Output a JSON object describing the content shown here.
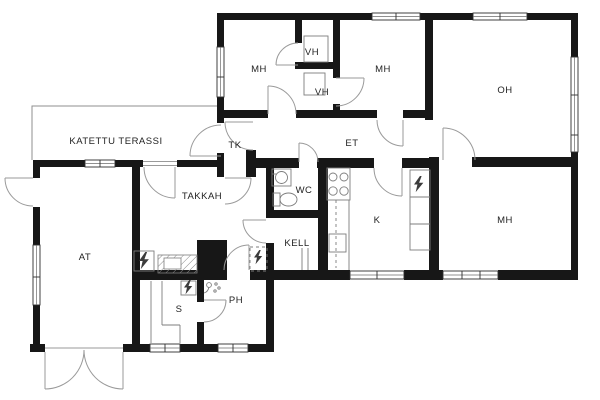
{
  "plan": {
    "title": "floor-plan",
    "rooms": [
      {
        "id": "terrace",
        "label": "KATETTU TERASSI"
      },
      {
        "id": "mh-top-left",
        "label": "MH"
      },
      {
        "id": "vh-upper",
        "label": "VH"
      },
      {
        "id": "vh-lower",
        "label": "VH"
      },
      {
        "id": "mh-top-mid",
        "label": "MH"
      },
      {
        "id": "oh",
        "label": "OH"
      },
      {
        "id": "tk",
        "label": "TK"
      },
      {
        "id": "et",
        "label": "ET"
      },
      {
        "id": "wc",
        "label": "WC"
      },
      {
        "id": "takkah",
        "label": "TAKKAH"
      },
      {
        "id": "kell",
        "label": "KELL"
      },
      {
        "id": "k",
        "label": "K"
      },
      {
        "id": "mh-bottom",
        "label": "MH"
      },
      {
        "id": "at",
        "label": "AT"
      },
      {
        "id": "s",
        "label": "S"
      },
      {
        "id": "ph",
        "label": "PH"
      }
    ],
    "icons": [
      "fireplace",
      "hearth-hatch",
      "stove-burners",
      "kitchen-cabinets",
      "washbasin",
      "toilet",
      "shower-mixer",
      "sauna-stove-electric",
      "electric-panel",
      "water-heater-electric",
      "sauna-benches",
      "closet-shelf",
      "cellar-hatch"
    ],
    "colors": {
      "wall": "#171717",
      "line": "#8f8f8f",
      "window": "#2e2e2e",
      "label": "#232323",
      "bg": "#ffffff"
    }
  }
}
